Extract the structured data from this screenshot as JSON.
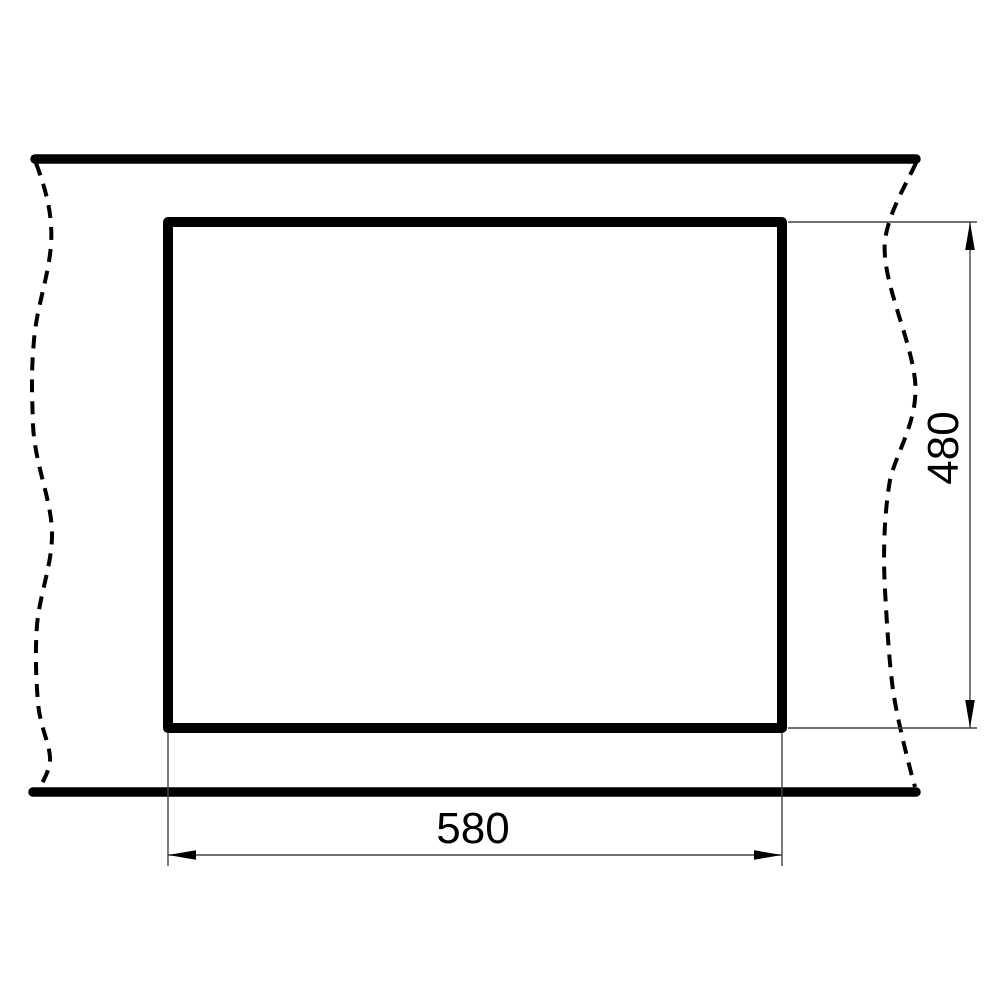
{
  "drawing": {
    "kind": "cutout-dimension-drawing",
    "background_color": "#ffffff",
    "thick_line_color": "#000000",
    "thin_line_color": "#444444",
    "text_color": "#000000",
    "dimensions": {
      "width": {
        "value": "580",
        "orientation": "horizontal"
      },
      "height": {
        "value": "480",
        "orientation": "vertical"
      }
    }
  }
}
